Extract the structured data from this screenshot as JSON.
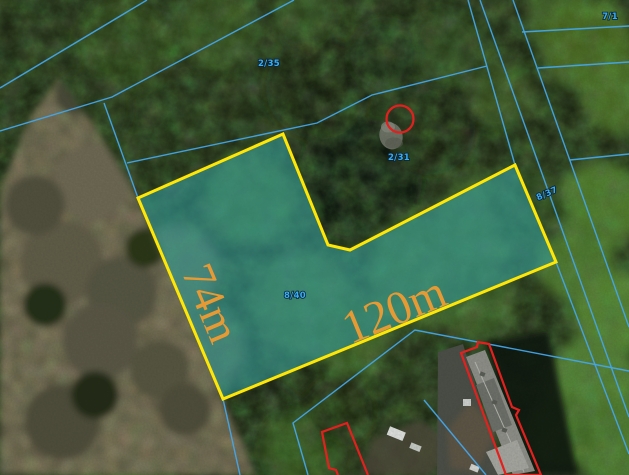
{
  "map_view": {
    "kind": "aerial-cadastral-map",
    "highlight": {
      "width_label": "74m",
      "length_label": "120m",
      "fill_color": "#349b9b",
      "border_color": "#ffe605",
      "dimension_text_color": "#e79a33"
    },
    "cadastral": {
      "line_color": "#45a5ea",
      "label_color": "#39adf5",
      "parcel_labels": {
        "p235": "2/35",
        "p231": "2/31",
        "p71": "7/1",
        "p837": "8/37",
        "p840": "8/40"
      }
    },
    "annotations": {
      "poi_circle_color": "#e3201e",
      "building_outline_color": "#e3201e"
    }
  }
}
